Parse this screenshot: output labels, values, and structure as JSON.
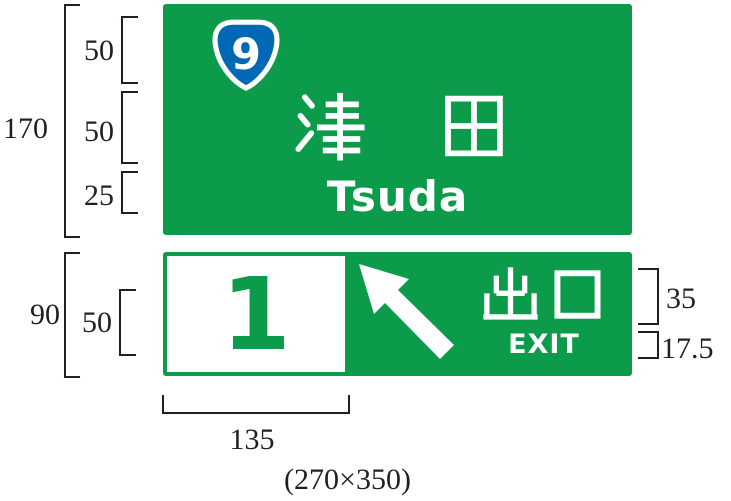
{
  "colors": {
    "sign_green": "#0b9b4b",
    "route_blue": "#0068b5",
    "text_white": "#ffffff",
    "dim_line": "#231f20"
  },
  "top_sign": {
    "route_number": "9",
    "kanji": "津田",
    "kanji_1": "津",
    "kanji_2": "田",
    "romaji": "Tsuda"
  },
  "bottom_sign": {
    "exit_number": "1",
    "kanji": "出口",
    "kanji_1": "出",
    "kanji_2": "口",
    "latin": "EXIT",
    "arrow_direction": "up-left"
  },
  "dimensions": {
    "total_height_top": "170",
    "shield_row_height": "50",
    "kanji_row_height": "50",
    "romaji_row_height": "25",
    "total_height_bottom": "90",
    "number_height": "50",
    "exit_kanji_height": "35",
    "exit_latin_height": "17.5",
    "number_box_width": "135",
    "overall_size": "(270×350)"
  }
}
